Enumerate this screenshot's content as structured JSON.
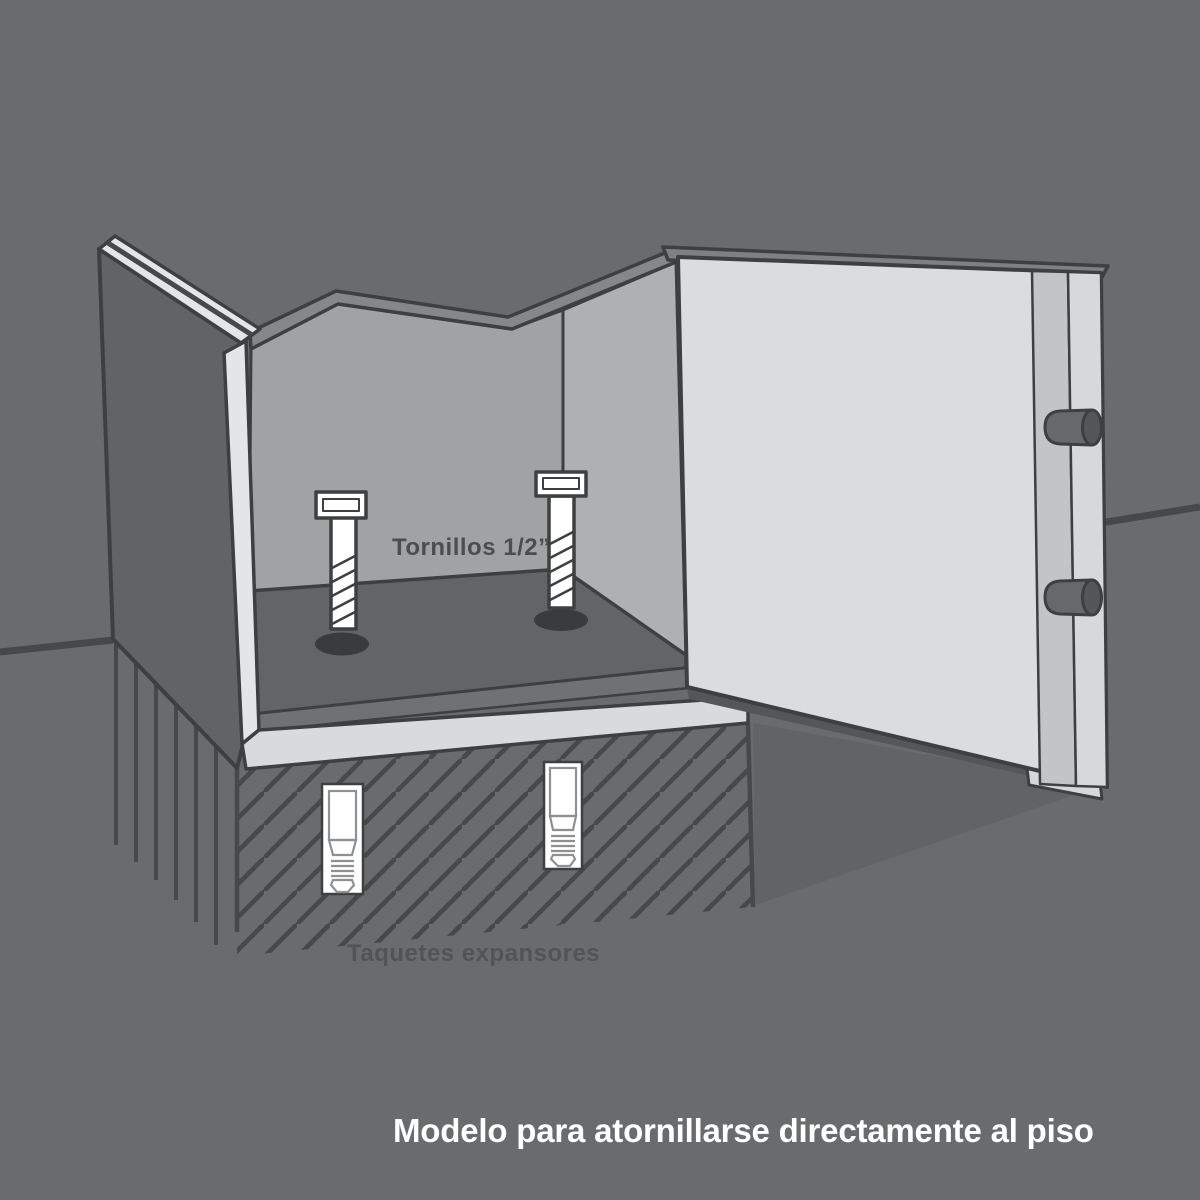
{
  "diagram": {
    "subject": "safe-anchored-to-floor-illustration",
    "labels": {
      "screws": "Tornillos 1/2”",
      "anchors": "Taquetes expansores",
      "caption": "Modelo para atornillarse directamente al piso"
    },
    "counts": {
      "floor_bolts": 2,
      "expansion_anchors": 2,
      "door_locking_bolts": 2
    },
    "colors": {
      "background": "#6a6b6d",
      "outline": "#3e3f41",
      "hatch_line": "#47484a",
      "wall_exterior": "#616365",
      "interior_wall": "#a0a2a4",
      "interior_wall_light": "#aeb0b2",
      "interior_flange": "#85878a",
      "interior_floor": "#626466",
      "interior_floor_band": "#6f7173",
      "bolt_hole": "#3a3b3d",
      "metal_edge_light": "#e4e5e6",
      "base_sill": "#d9dadb",
      "door_face": "#dadcde",
      "door_strip_mid": "#c3c4c6",
      "door_strip_right": "#d7d8da",
      "locking_bolt_body": "#66686a",
      "locking_bolt_cap": "#54565a",
      "shadow": "#54565a",
      "under_door_shadow": "#626366",
      "label_dark": "#4b4d50",
      "caption_text": "#ffffff",
      "hardware_white": "#ffffff"
    }
  }
}
